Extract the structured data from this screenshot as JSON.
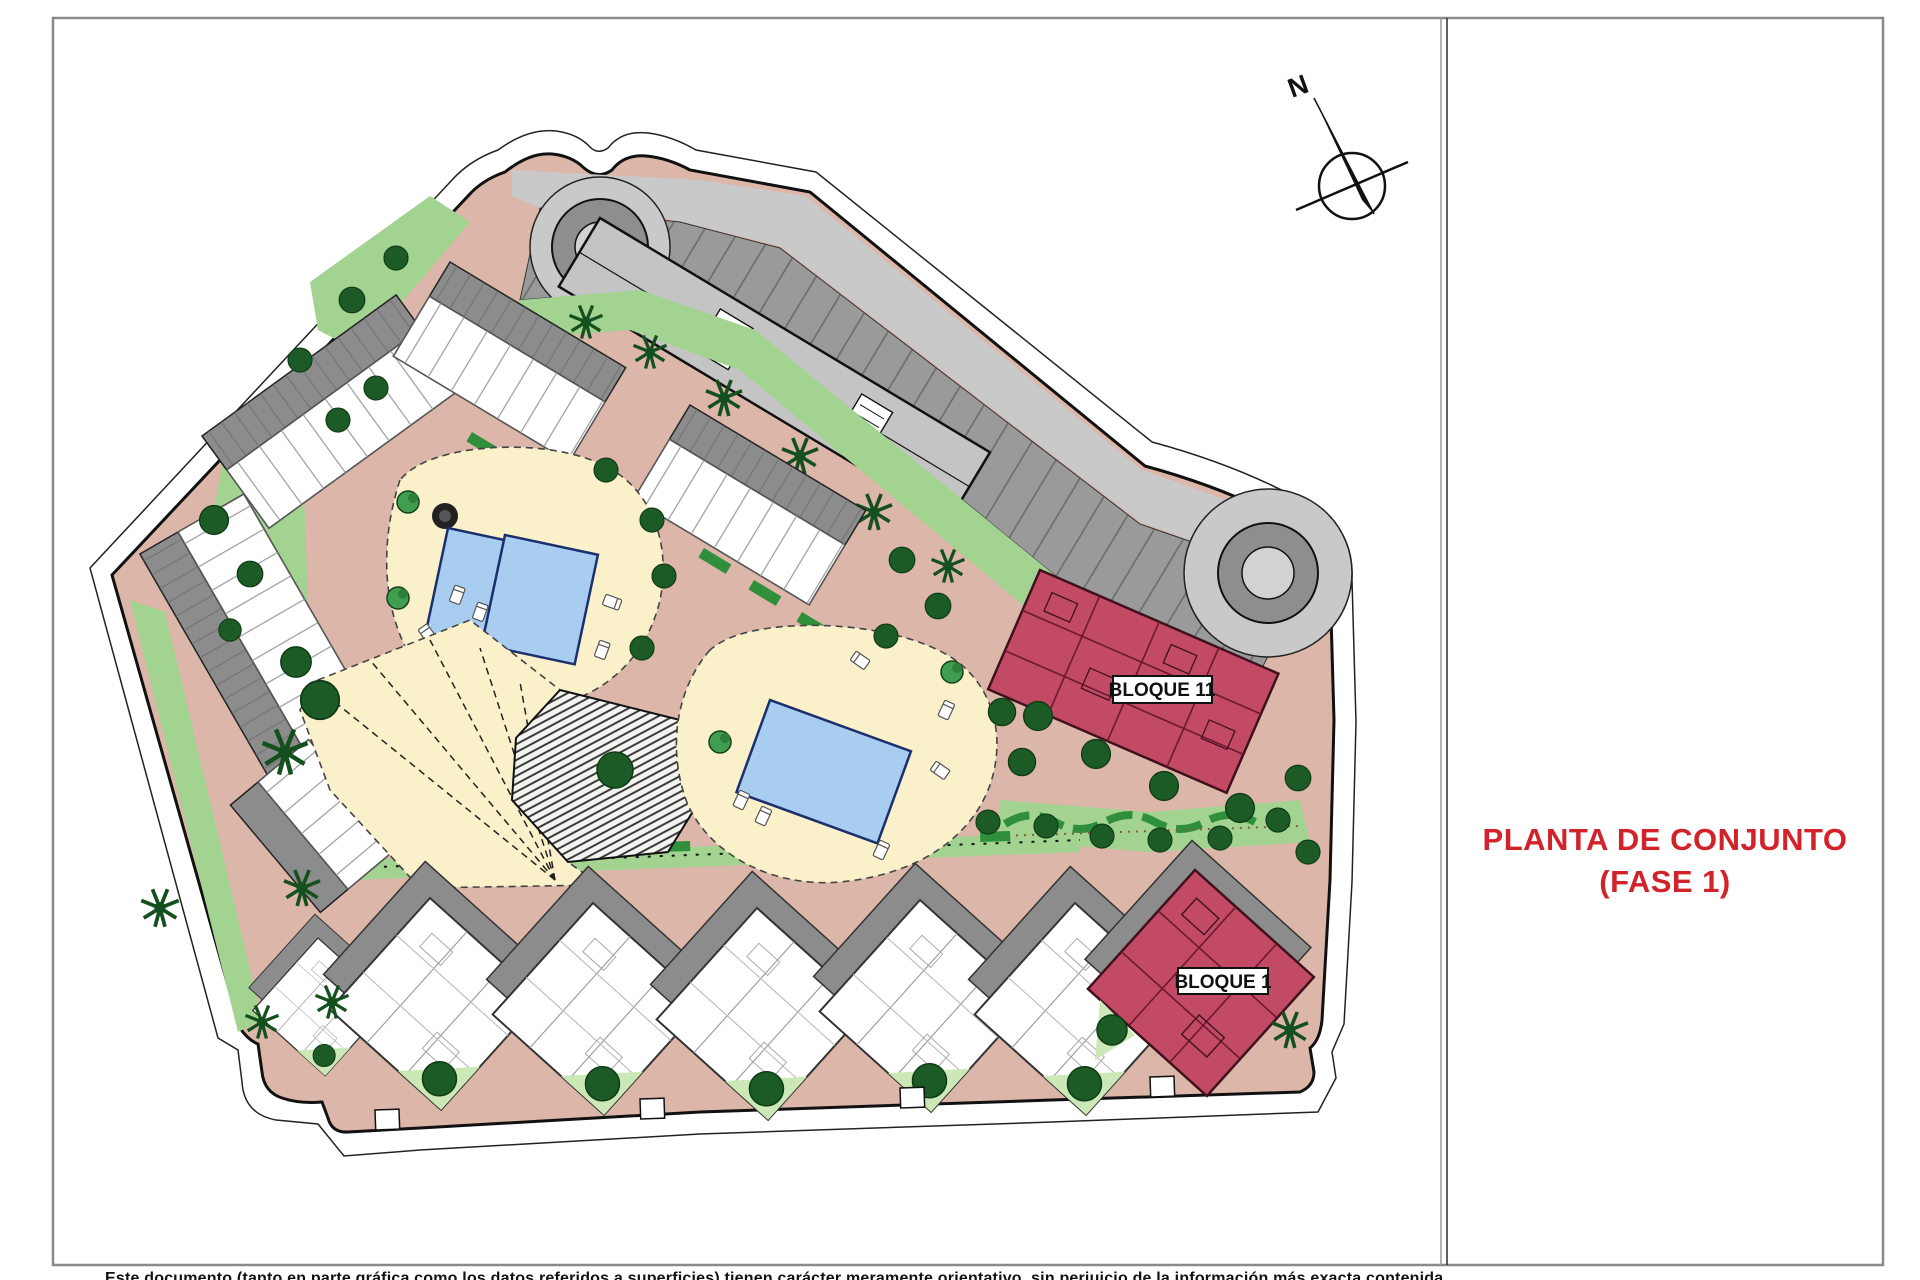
{
  "sheet": {
    "title_line1": "PLANTA DE CONJUNTO",
    "title_line2": "(FASE 1)",
    "disclaimer": "Este documento (tanto en parte gráfica como los datos referidos a superficies) tienen carácter meramente orientativo, sin perjuicio de la información más exacta contenida",
    "compass_label": "N"
  },
  "plan": {
    "labels": {
      "bloque11": "BLOQUE 11",
      "bloque1": "BLOQUE 1"
    }
  },
  "colors": {
    "accent_red": "#D2232A",
    "site_path_salmon": "#DDB6AA",
    "lawn_green": "#A3D391",
    "lawn_light": "#CBE8B6",
    "hedge_green": "#2F8F3C",
    "tree_green": "#1D5B26",
    "pool_blue": "#A9CDF1",
    "pool_border": "#1B2F6E",
    "deck_cream": "#FAF1CB",
    "parking_dark": "#9A9A9A",
    "parking_light": "#C9C9C9",
    "building_white": "#FFFFFF",
    "roof_gray": "#8C8C8C",
    "bloque_crimson": "#C24A64"
  }
}
